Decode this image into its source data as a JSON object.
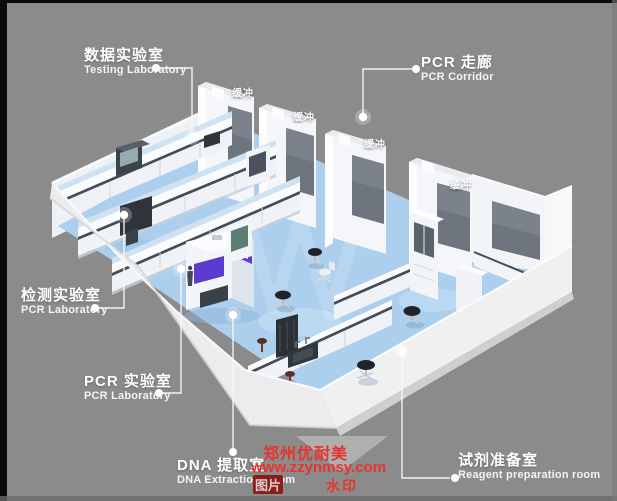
{
  "colors": {
    "background": "#8b8b8b",
    "floor": "#abcfec",
    "accent_purple": "#5b3bd0",
    "window_glass": "#6e757e",
    "watermark_red": "#e8332e",
    "countertop": "#454c55",
    "text_white": "#ffffff"
  },
  "labels": {
    "testing_lab": {
      "zh": "数据实验室",
      "en": "Testing Laboratory"
    },
    "pcr_corridor": {
      "zh": "PCR 走廊",
      "en": "PCR Corridor"
    },
    "detection_lab": {
      "zh": "检测实验室",
      "en": "PCR Laboratory"
    },
    "pcr_lab": {
      "zh": "PCR 实验室",
      "en": "PCR Laboratory"
    },
    "dna_extraction": {
      "zh": "DNA 提取室",
      "en": "DNA Extraction Room"
    },
    "reagent_prep": {
      "zh": "试剂准备室",
      "en": "Reagent preparation room"
    }
  },
  "buffer_labels": [
    {
      "text": "缓冲"
    },
    {
      "text": "缓冲"
    },
    {
      "text": "缓冲"
    },
    {
      "text": "缓冲"
    }
  ],
  "watermark": {
    "company": "郑州优耐美",
    "url": "www.zzynmsy.com",
    "stamp_left": "图片",
    "stamp_right": "水印"
  }
}
